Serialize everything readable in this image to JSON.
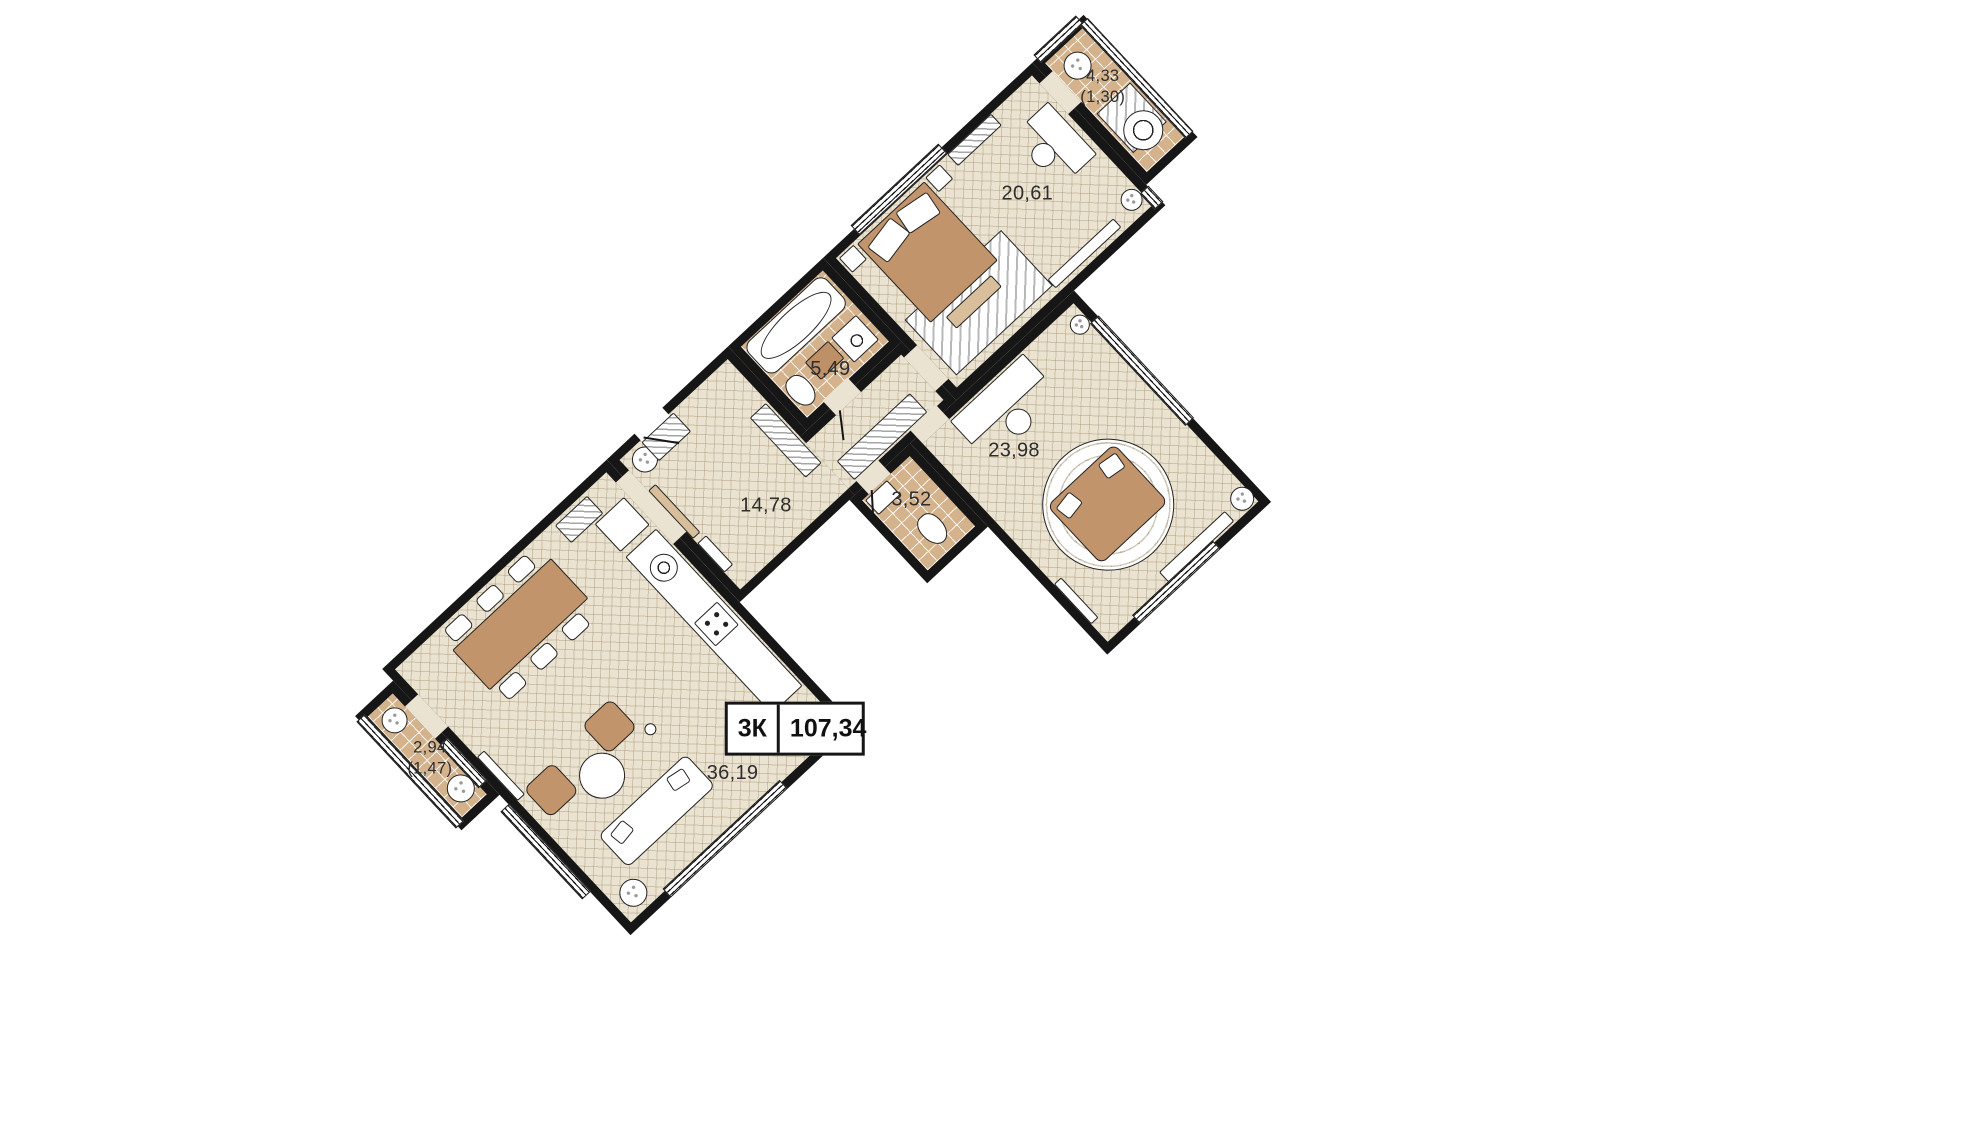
{
  "plan": {
    "type_label": "3К",
    "total_area": "107,34",
    "rooms": [
      {
        "id": "bedroom",
        "area": "20,61"
      },
      {
        "id": "balcony-top",
        "area": "4,33",
        "area_reduced": "(1,30)"
      },
      {
        "id": "bathroom",
        "area": "5,49"
      },
      {
        "id": "hallway",
        "area": "14,78"
      },
      {
        "id": "living-room",
        "area": "23,98"
      },
      {
        "id": "wc",
        "area": "3,52"
      },
      {
        "id": "kitchen-living-room",
        "area": "36,19"
      },
      {
        "id": "balcony-bottom",
        "area": "2,94",
        "area_reduced": "(1,47)"
      }
    ],
    "colors": {
      "wall": "#161616",
      "floor": "#EBE3D1",
      "tile": "#D3B28C",
      "wood": "#C2946C",
      "wood-light": "#D8BE9A",
      "paper": "#ffffff",
      "label": "#2e2e2e"
    }
  }
}
